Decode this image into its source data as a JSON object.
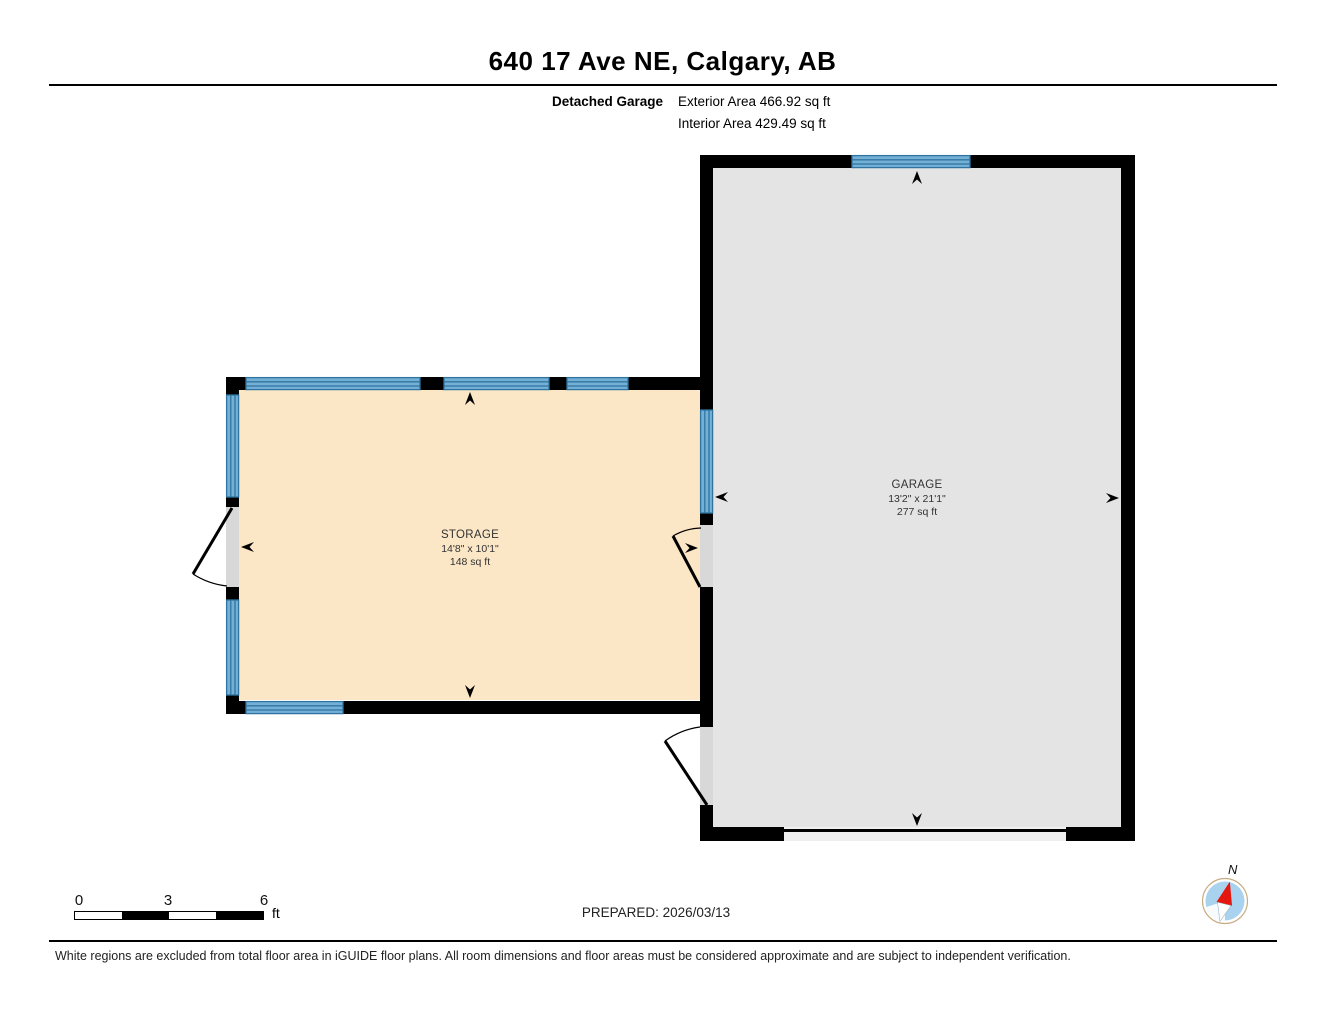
{
  "header": {
    "title": "640 17 Ave NE, Calgary, AB",
    "floor_label": "Detached Garage",
    "exterior_area": "Exterior Area 466.92 sq ft",
    "interior_area": "Interior Area 429.49 sq ft"
  },
  "rooms": [
    {
      "name": "STORAGE",
      "dimensions": "14'8\" x 10'1\"",
      "area": "148 sq ft",
      "fill": "#fbe6c6"
    },
    {
      "name": "GARAGE",
      "dimensions": "13'2\" x 21'1\"",
      "area": "277 sq ft",
      "fill": "#e4e4e4"
    }
  ],
  "scale_bar": {
    "tick_0": "0",
    "tick_3": "3",
    "tick_6": "6",
    "unit": "ft"
  },
  "prepared": "PREPARED: 2026/03/13",
  "compass": {
    "label": "N"
  },
  "footer": {
    "disclaimer": "White regions are excluded from total floor area in iGUIDE floor plans. All room dimensions and floor areas must be considered approximate and are subject to independent verification."
  },
  "colors": {
    "wall": "#000000",
    "window": "#74b0d6",
    "window_line": "#2f74a0",
    "door_opening": "#d8d8d8",
    "storage_fill": "#fbe6c6",
    "garage_fill": "#e4e4e4",
    "compass_blue": "#a9d2ee",
    "compass_red": "#e3170d"
  }
}
